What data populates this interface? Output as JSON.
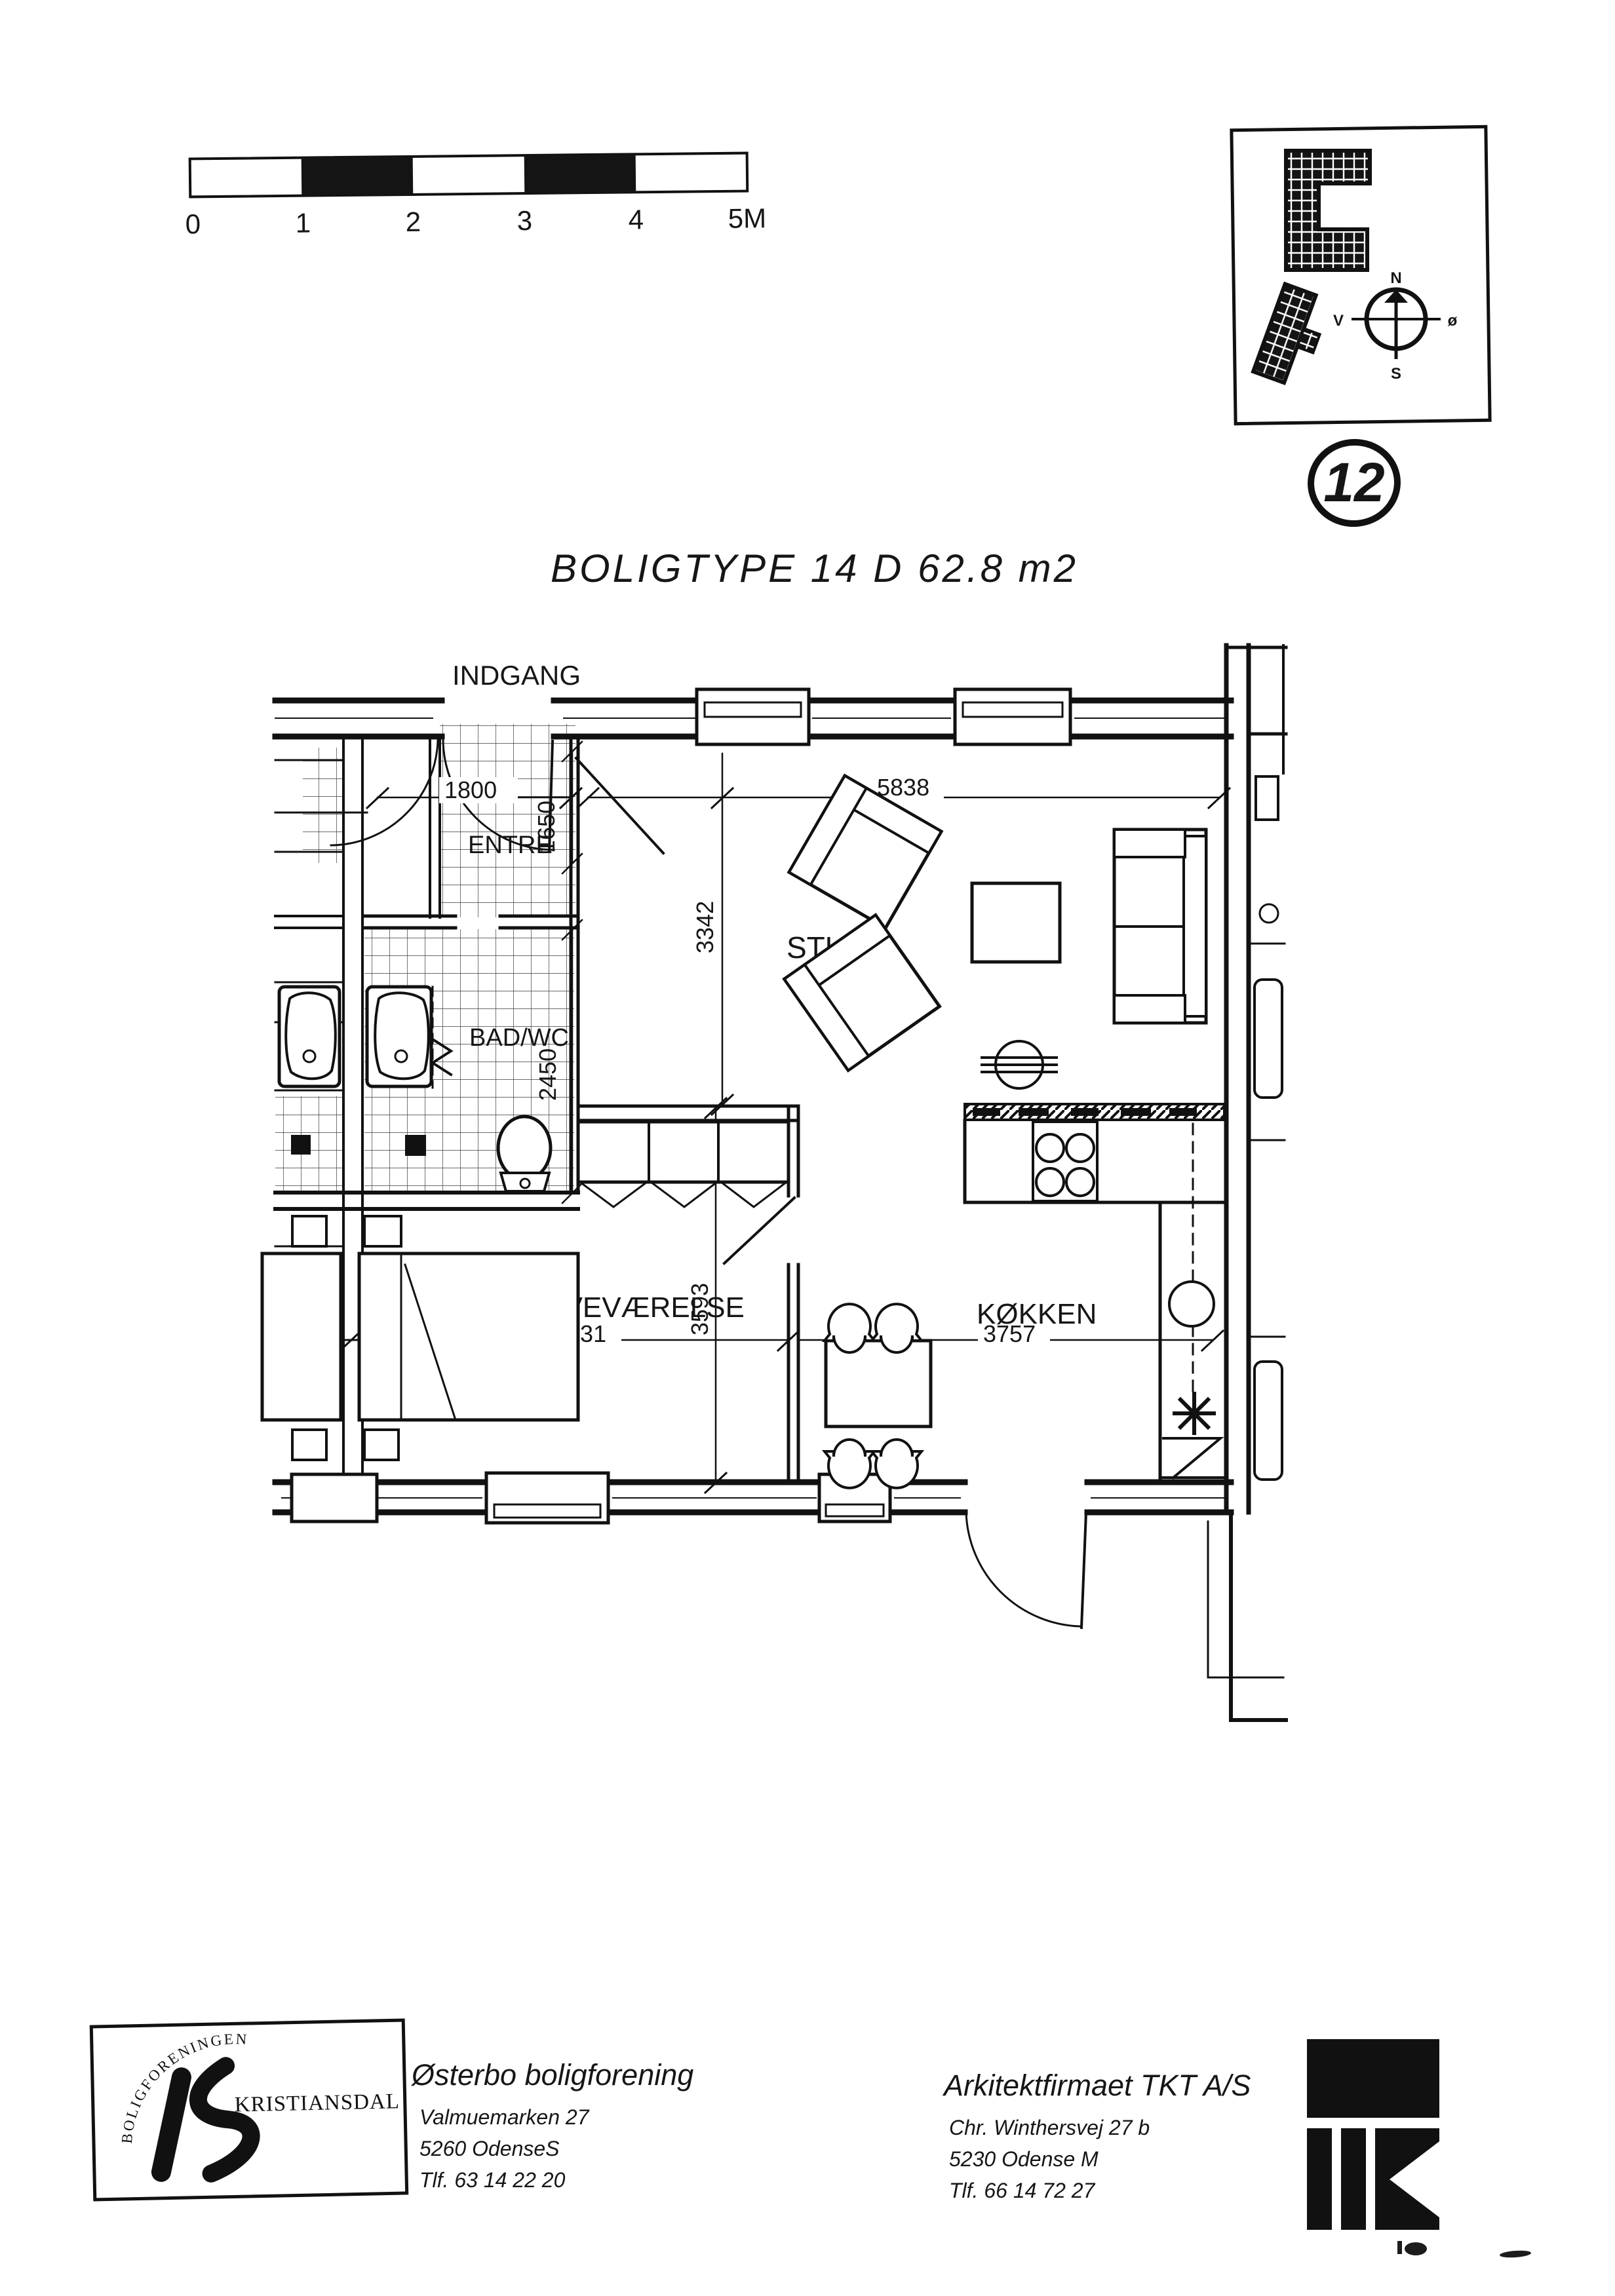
{
  "sheet": {
    "number": "12",
    "title": "BOLIGTYPE 14 D 62.8 m2"
  },
  "scale_bar": {
    "unit_note": "meters",
    "ticks": [
      "0",
      "1",
      "2",
      "3",
      "4",
      "5M"
    ]
  },
  "site_plan": {
    "compass": {
      "north": "N",
      "south": "S",
      "west": "V",
      "east": "ø"
    }
  },
  "plan": {
    "entrance_label": "INDGANG",
    "rooms": {
      "entre": "ENTRE",
      "bath": "BAD/WC",
      "living": "STUE",
      "bedroom": "SOVEVÆRELSE",
      "kitchen": "KØKKEN"
    },
    "dims": {
      "entre_width": "1800",
      "entre_depth": "1650",
      "living_width": "5838",
      "living_depth": "3342",
      "bath_depth": "2450",
      "bedroom_width": "3931",
      "bedroom_depth": "3593",
      "kitchen_width": "3757"
    }
  },
  "footer": {
    "association": {
      "arc_text": "BOLIGFORENINGEN",
      "logo_name": "KRISTIANSDAL",
      "name": "Østerbo boligforening",
      "address1": "Valmuemarken 27",
      "address2": "5260 OdenseS",
      "phone": "Tlf. 63 14 22 20"
    },
    "architect": {
      "name": "Arkitektfirmaet TKT A/S",
      "address1": "Chr. Winthersvej 27 b",
      "address2": "5230 Odense M",
      "phone": "Tlf. 66 14 72 27"
    }
  }
}
